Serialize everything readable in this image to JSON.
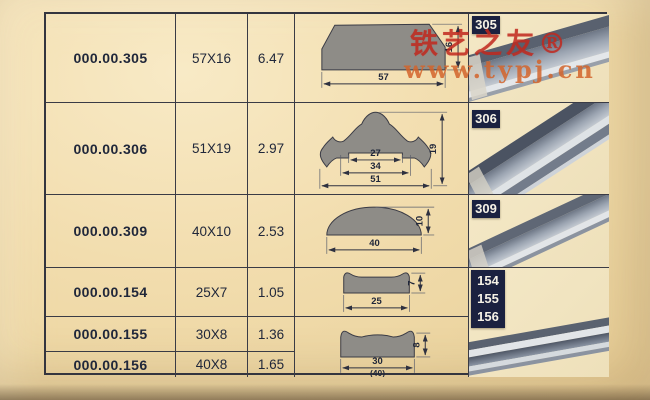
{
  "watermark": {
    "brand": "铁艺之友®",
    "site": "www.typj.cn"
  },
  "table": {
    "rows": [
      {
        "code": "000.00.305",
        "size": "57X16",
        "weight": "6.47"
      },
      {
        "code": "000.00.306",
        "size": "51X19",
        "weight": "2.97"
      },
      {
        "code": "000.00.309",
        "size": "40X10",
        "weight": "2.53"
      },
      {
        "code": "000.00.154",
        "size": "25X7",
        "weight": "1.05"
      },
      {
        "code": "000.00.155",
        "size": "30X8",
        "weight": "1.36"
      },
      {
        "code": "000.00.156",
        "size": "40X8",
        "weight": "1.65"
      }
    ]
  },
  "diagrams": {
    "d305": {
      "width": "57",
      "height": "16"
    },
    "d306": {
      "dim_inner": "27",
      "dim_mid": "34",
      "dim_outer": "51",
      "height": "19"
    },
    "d309": {
      "width": "40",
      "height": "10"
    },
    "d154": {
      "width": "25",
      "height": "7"
    },
    "d155_156": {
      "width": "30",
      "width_alt": "(40)",
      "height": "8"
    }
  },
  "photo_labels": {
    "p305": "305",
    "p306": "306",
    "p309": "309",
    "p154": "154",
    "p155": "155",
    "p156": "156"
  },
  "colors": {
    "background": "#f0dcab",
    "table_line": "#3a3b45",
    "profile_fill": "#8e8c87",
    "label_bg": "#1b2140",
    "label_text": "#f5f1e6",
    "brand_red": "#c1281e",
    "site_orange": "#d2642c",
    "metal": "#8b95a4"
  }
}
